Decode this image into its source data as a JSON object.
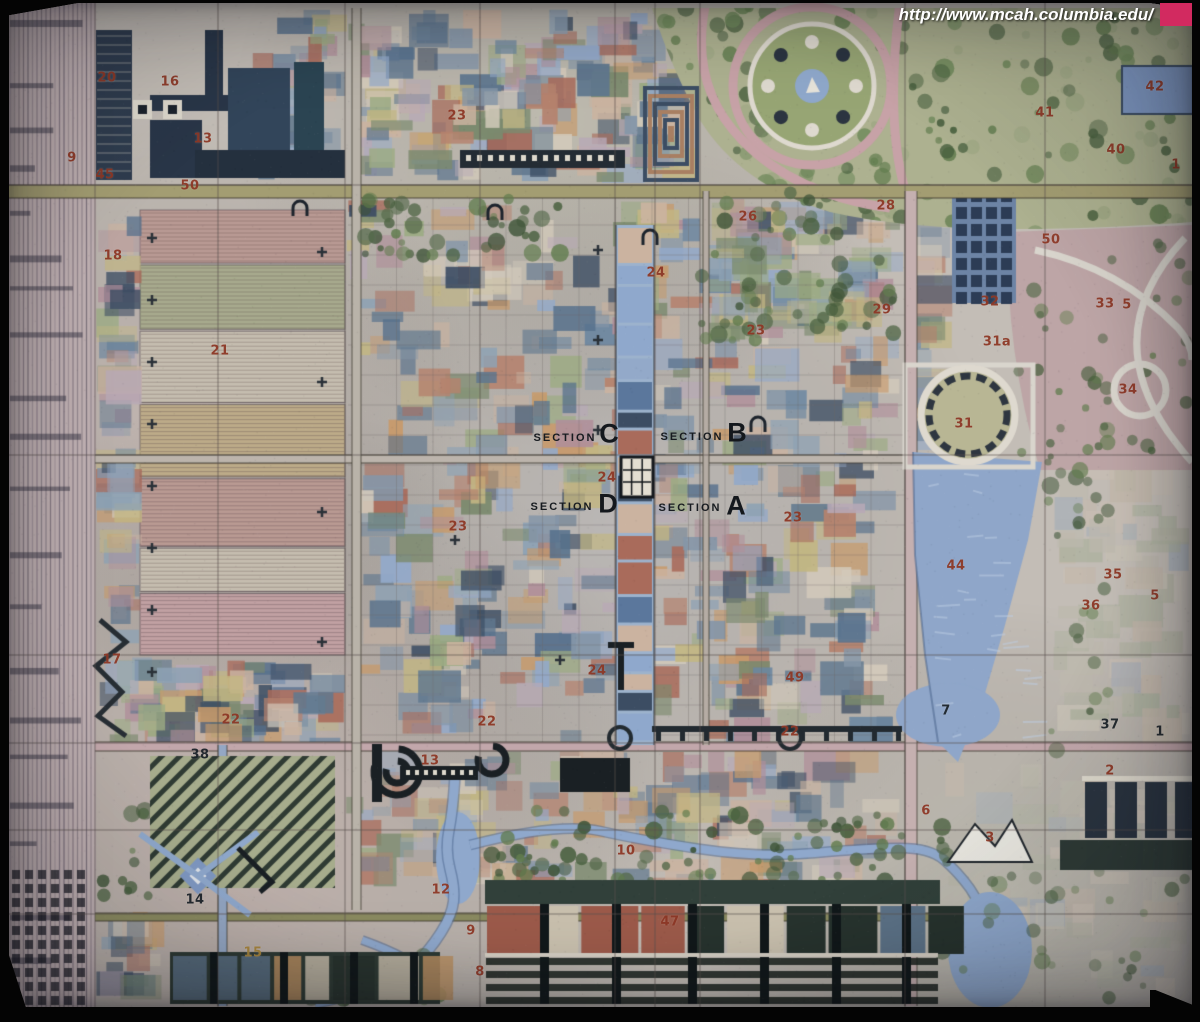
{
  "watermark": {
    "url": "http://www.mcah.columbia.edu/",
    "square_color": "#d22a60"
  },
  "colors": {
    "red": "#8e3826",
    "dark": "#1d242b",
    "gold": "#a9863c"
  },
  "map": {
    "sections": [
      {
        "word": "SECTION",
        "letter": "C",
        "wx": 565,
        "wy": 438,
        "lx": 609,
        "ly": 434
      },
      {
        "word": "SECTION",
        "letter": "B",
        "wx": 692,
        "wy": 437,
        "lx": 737,
        "ly": 433
      },
      {
        "word": "SECTION",
        "letter": "D",
        "wx": 562,
        "wy": 507,
        "lx": 608,
        "ly": 504
      },
      {
        "word": "SECTION",
        "letter": "A",
        "wx": 690,
        "wy": 508,
        "lx": 736,
        "ly": 506
      }
    ],
    "numbers": [
      {
        "t": "20",
        "x": 107,
        "y": 78,
        "c": "red"
      },
      {
        "t": "16",
        "x": 170,
        "y": 82,
        "c": "red"
      },
      {
        "t": "13",
        "x": 203,
        "y": 139,
        "c": "red"
      },
      {
        "t": "9",
        "x": 72,
        "y": 158,
        "c": "red"
      },
      {
        "t": "45",
        "x": 105,
        "y": 175,
        "c": "red"
      },
      {
        "t": "50",
        "x": 190,
        "y": 186,
        "c": "red"
      },
      {
        "t": "18",
        "x": 113,
        "y": 256,
        "c": "red"
      },
      {
        "t": "21",
        "x": 220,
        "y": 351,
        "c": "red"
      },
      {
        "t": "23",
        "x": 457,
        "y": 116,
        "c": "red"
      },
      {
        "t": "24",
        "x": 656,
        "y": 273,
        "c": "red"
      },
      {
        "t": "26",
        "x": 748,
        "y": 217,
        "c": "red"
      },
      {
        "t": "28",
        "x": 886,
        "y": 206,
        "c": "red"
      },
      {
        "t": "29",
        "x": 882,
        "y": 310,
        "c": "red"
      },
      {
        "t": "23",
        "x": 756,
        "y": 331,
        "c": "red"
      },
      {
        "t": "42",
        "x": 1155,
        "y": 87,
        "c": "red"
      },
      {
        "t": "41",
        "x": 1045,
        "y": 113,
        "c": "red"
      },
      {
        "t": "40",
        "x": 1116,
        "y": 150,
        "c": "red"
      },
      {
        "t": "1",
        "x": 1176,
        "y": 165,
        "c": "red"
      },
      {
        "t": "50",
        "x": 1051,
        "y": 240,
        "c": "red"
      },
      {
        "t": "32",
        "x": 990,
        "y": 302,
        "c": "red"
      },
      {
        "t": "33",
        "x": 1105,
        "y": 304,
        "c": "red"
      },
      {
        "t": "5",
        "x": 1127,
        "y": 305,
        "c": "red"
      },
      {
        "t": "31a",
        "x": 997,
        "y": 342,
        "c": "red"
      },
      {
        "t": "34",
        "x": 1128,
        "y": 390,
        "c": "red"
      },
      {
        "t": "31",
        "x": 964,
        "y": 424,
        "c": "red"
      },
      {
        "t": "44",
        "x": 956,
        "y": 566,
        "c": "red"
      },
      {
        "t": "35",
        "x": 1113,
        "y": 575,
        "c": "red"
      },
      {
        "t": "36",
        "x": 1091,
        "y": 606,
        "c": "red"
      },
      {
        "t": "5",
        "x": 1155,
        "y": 596,
        "c": "red"
      },
      {
        "t": "37",
        "x": 1110,
        "y": 725,
        "c": "dark"
      },
      {
        "t": "2",
        "x": 1110,
        "y": 771,
        "c": "red"
      },
      {
        "t": "1",
        "x": 1160,
        "y": 732,
        "c": "dark"
      },
      {
        "t": "6",
        "x": 926,
        "y": 811,
        "c": "red"
      },
      {
        "t": "3",
        "x": 990,
        "y": 838,
        "c": "red"
      },
      {
        "t": "7",
        "x": 946,
        "y": 711,
        "c": "dark"
      },
      {
        "t": "10",
        "x": 626,
        "y": 851,
        "c": "red"
      },
      {
        "t": "12",
        "x": 441,
        "y": 890,
        "c": "red"
      },
      {
        "t": "13",
        "x": 430,
        "y": 761,
        "c": "red"
      },
      {
        "t": "47",
        "x": 670,
        "y": 922,
        "c": "red"
      },
      {
        "t": "9",
        "x": 471,
        "y": 931,
        "c": "red"
      },
      {
        "t": "8",
        "x": 480,
        "y": 972,
        "c": "red"
      },
      {
        "t": "14",
        "x": 195,
        "y": 900,
        "c": "dark"
      },
      {
        "t": "15",
        "x": 253,
        "y": 953,
        "c": "gold"
      },
      {
        "t": "38",
        "x": 200,
        "y": 755,
        "c": "dark"
      },
      {
        "t": "22",
        "x": 231,
        "y": 720,
        "c": "red"
      },
      {
        "t": "22",
        "x": 487,
        "y": 722,
        "c": "red"
      },
      {
        "t": "22",
        "x": 790,
        "y": 732,
        "c": "red"
      },
      {
        "t": "17",
        "x": 112,
        "y": 660,
        "c": "red"
      },
      {
        "t": "24",
        "x": 597,
        "y": 671,
        "c": "red"
      },
      {
        "t": "49",
        "x": 795,
        "y": 678,
        "c": "red"
      },
      {
        "t": "24",
        "x": 607,
        "y": 478,
        "c": "red"
      },
      {
        "t": "23",
        "x": 458,
        "y": 527,
        "c": "red"
      },
      {
        "t": "23",
        "x": 793,
        "y": 518,
        "c": "red"
      }
    ]
  }
}
